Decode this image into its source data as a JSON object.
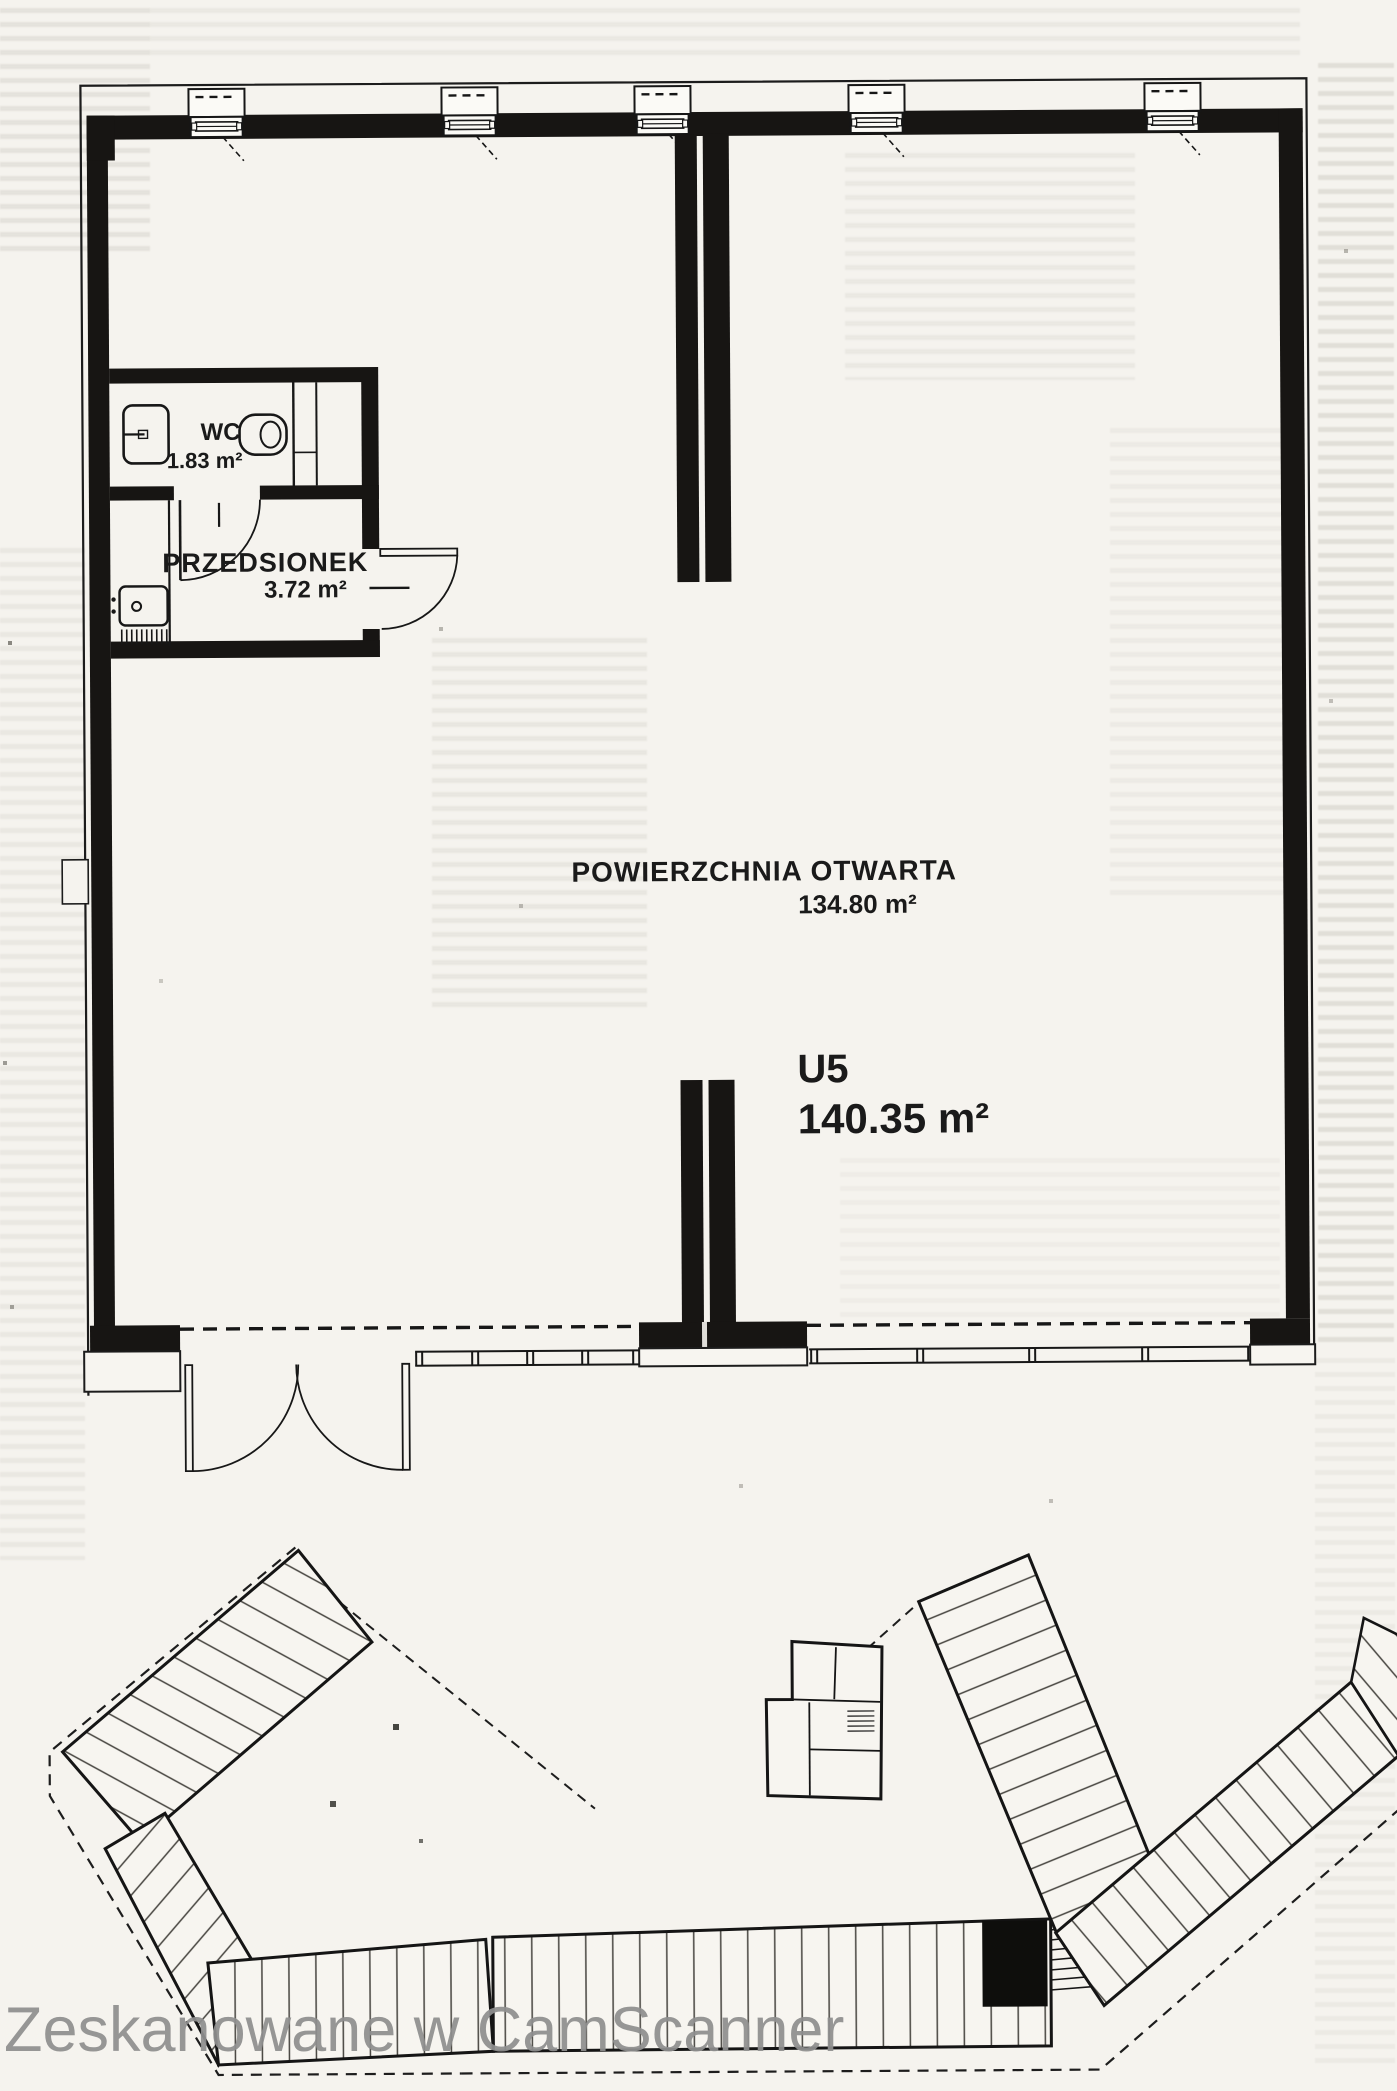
{
  "page": {
    "watermark": "Zeskanowane w CamScanner"
  },
  "floor_plan": {
    "unit_label": "U5",
    "unit_area": "140.35 m²",
    "rooms": [
      {
        "name": "WC",
        "area": "1.83 m²"
      },
      {
        "name": "PRZEDSIONEK",
        "area": "3.72 m²"
      },
      {
        "name": "POWIERZCHNIA OTWARTA",
        "area": "134.80 m²"
      }
    ],
    "line_color": "#171717",
    "paper_color": "#f5f3ee"
  }
}
